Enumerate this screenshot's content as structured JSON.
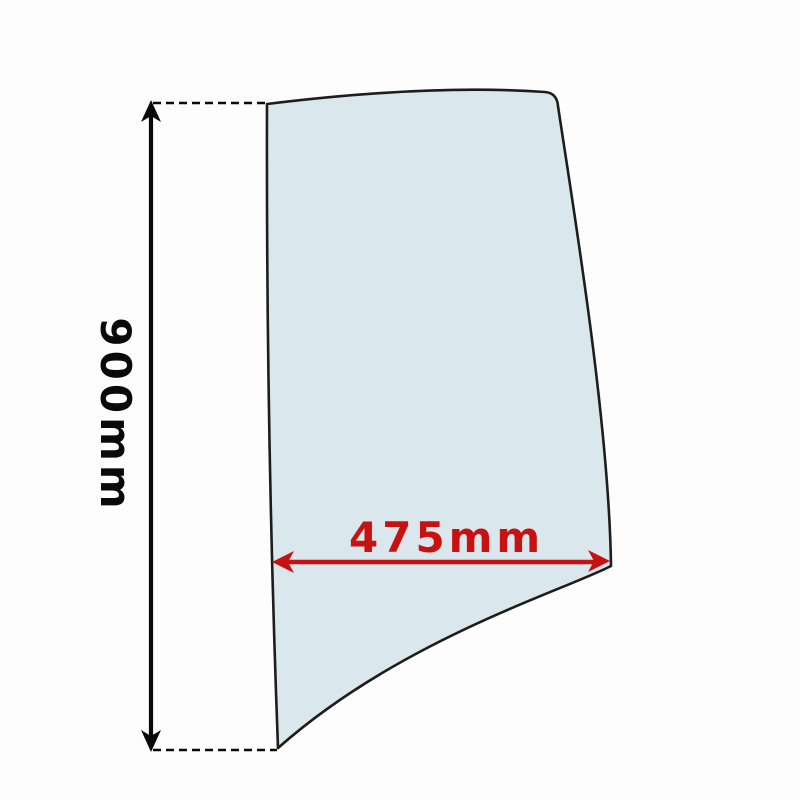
{
  "diagram": {
    "kind": "glass-panel-dimension-diagram",
    "dimensions": {
      "height_label": "900mm",
      "width_label": "475mm"
    },
    "colors": {
      "background": "#fdfdfd",
      "glass_fill": "#dae7ec",
      "outline_color": "#1d1d1d",
      "dimension_black": "#0a0a0a",
      "dimension_red": "#c81212"
    }
  }
}
